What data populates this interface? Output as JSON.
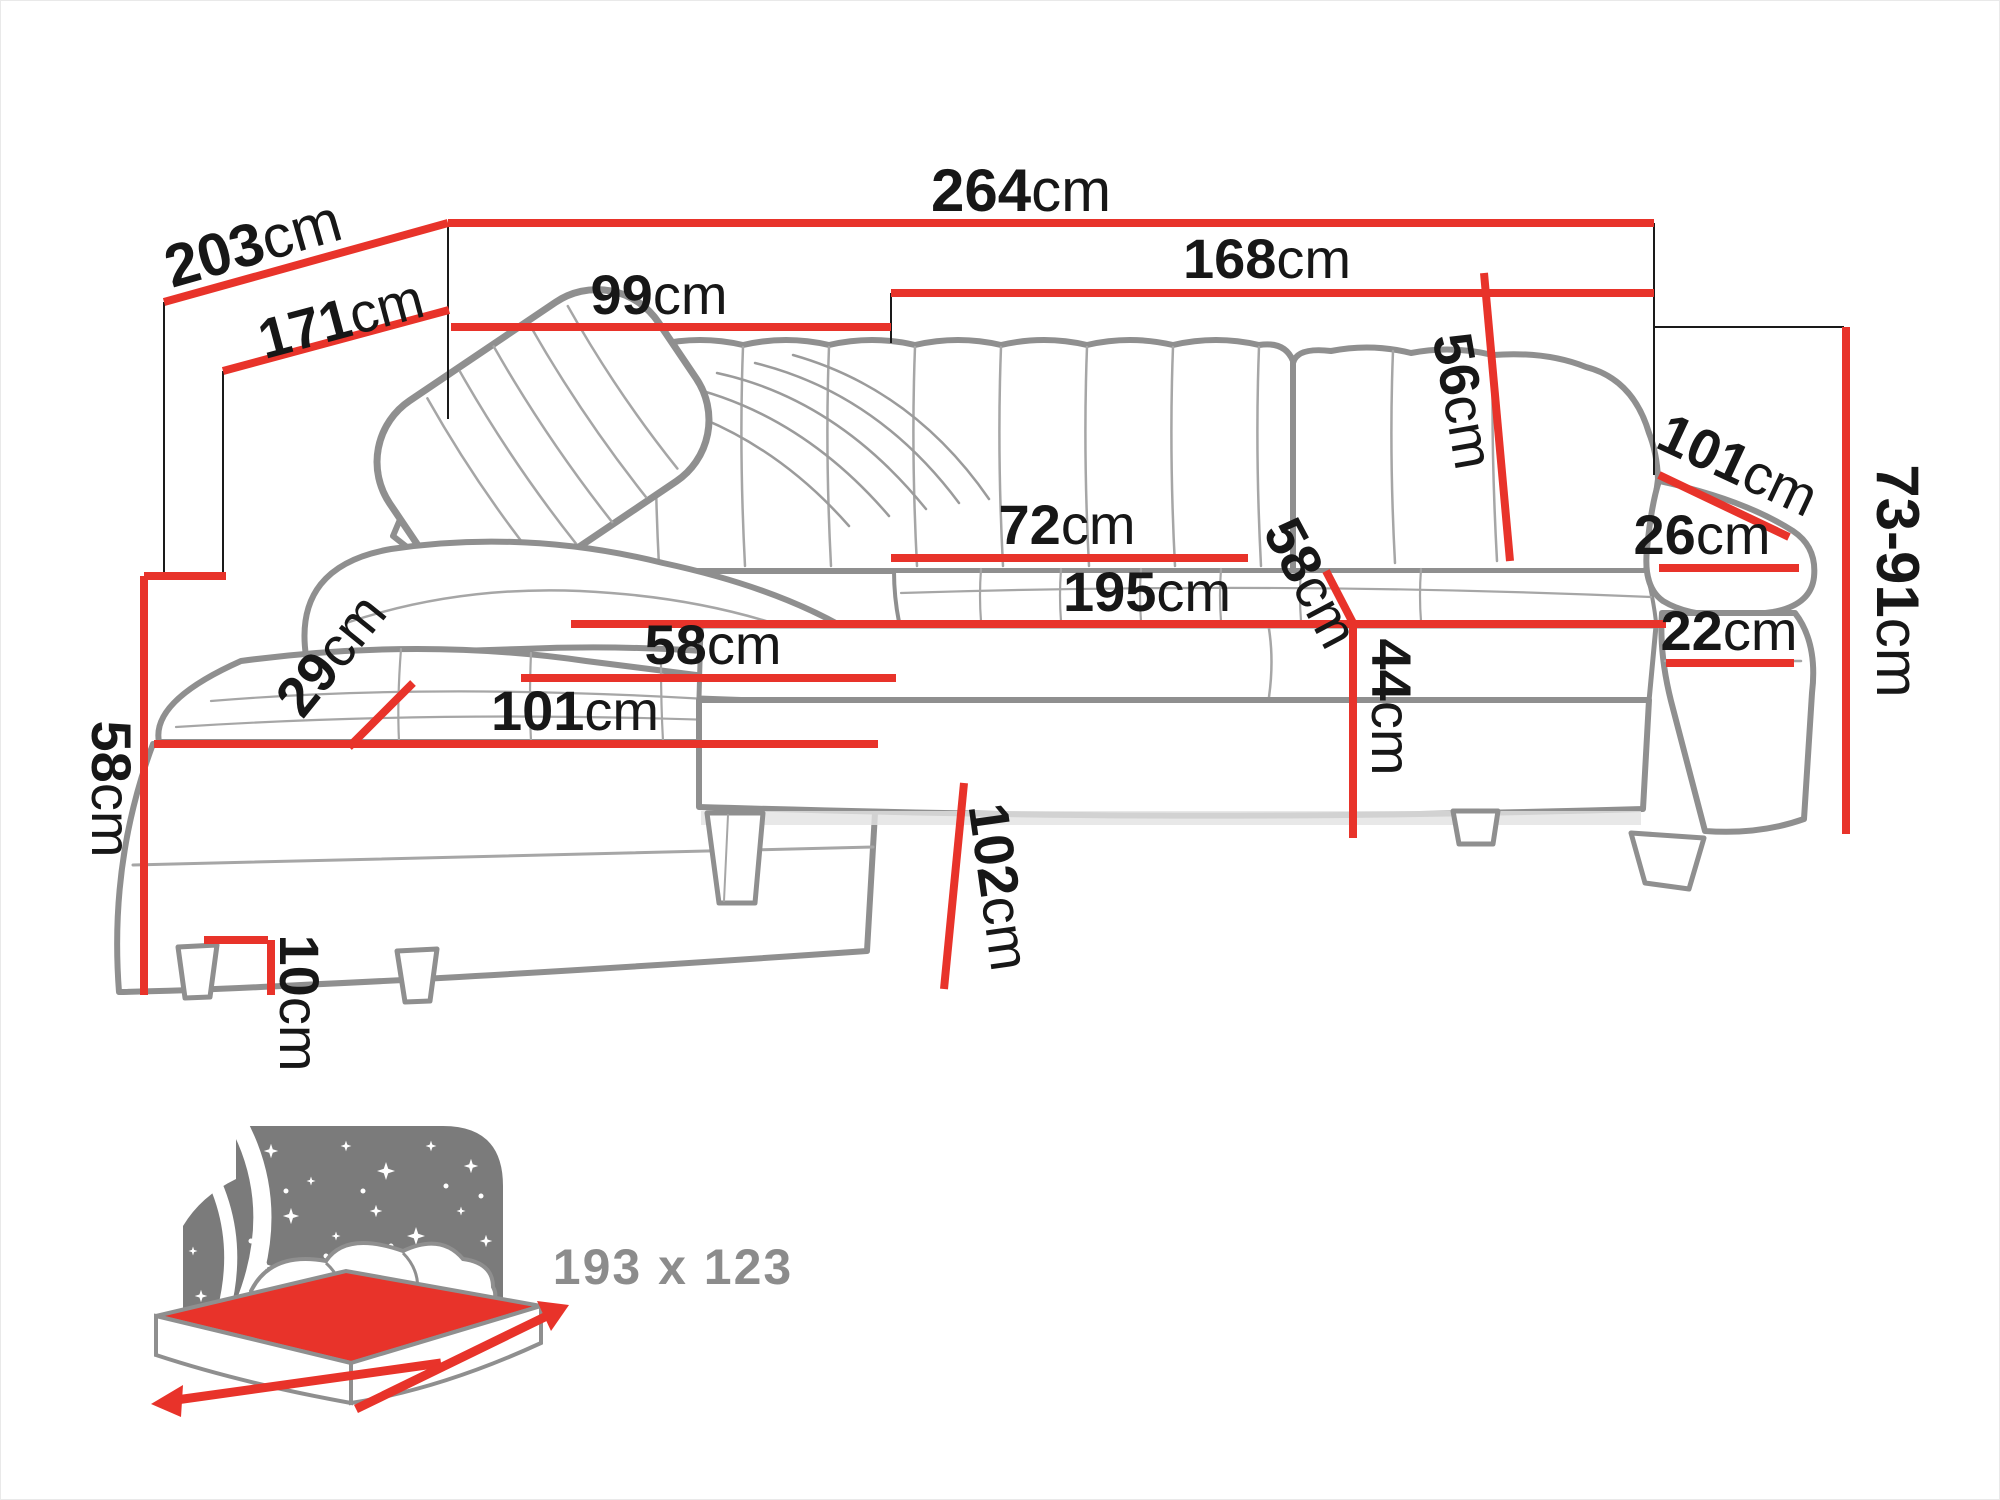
{
  "diagram": {
    "type": "sofa-dimension-drawing",
    "product": "corner sofa with sleeping function",
    "unit_default": "cm"
  },
  "colors": {
    "dimension_line": "#e8332a",
    "construction_line": "#1a1a1a",
    "sofa_outline": "#8f8f8f",
    "icon_gray": "#7b7b7b",
    "label_text": "#171717",
    "bed_label_text": "#8c8c8c"
  },
  "dimensions": {
    "depth_total": {
      "value": "203",
      "unit": "cm"
    },
    "depth_inner": {
      "value": "171",
      "unit": "cm"
    },
    "width_total": {
      "value": "264",
      "unit": "cm"
    },
    "corner_back_width": {
      "value": "99",
      "unit": "cm"
    },
    "seat_section_width": {
      "value": "168",
      "unit": "cm"
    },
    "backrest_height": {
      "value": "56",
      "unit": "cm"
    },
    "arm_outer_length": {
      "value": "101",
      "unit": "cm"
    },
    "arm_pad_width": {
      "value": "26",
      "unit": "cm"
    },
    "arm_front_width": {
      "value": "22",
      "unit": "cm"
    },
    "height_range": {
      "value": "73-91",
      "unit": "cm"
    },
    "seat_depth": {
      "value": "72",
      "unit": "cm"
    },
    "seat_width": {
      "value": "195",
      "unit": "cm"
    },
    "seat_depth_corner": {
      "value": "58",
      "unit": "cm"
    },
    "seat_height": {
      "value": "44",
      "unit": "cm"
    },
    "chaise_seat_width": {
      "value": "58",
      "unit": "cm"
    },
    "chaise_length": {
      "value": "101",
      "unit": "cm"
    },
    "chaise_arm_width": {
      "value": "29",
      "unit": "cm"
    },
    "side_height": {
      "value": "58",
      "unit": "cm"
    },
    "leg_height": {
      "value": "10",
      "unit": "cm"
    },
    "chaise_depth": {
      "value": "102",
      "unit": "cm"
    }
  },
  "sleeping_area": {
    "label": "193 x 123"
  }
}
